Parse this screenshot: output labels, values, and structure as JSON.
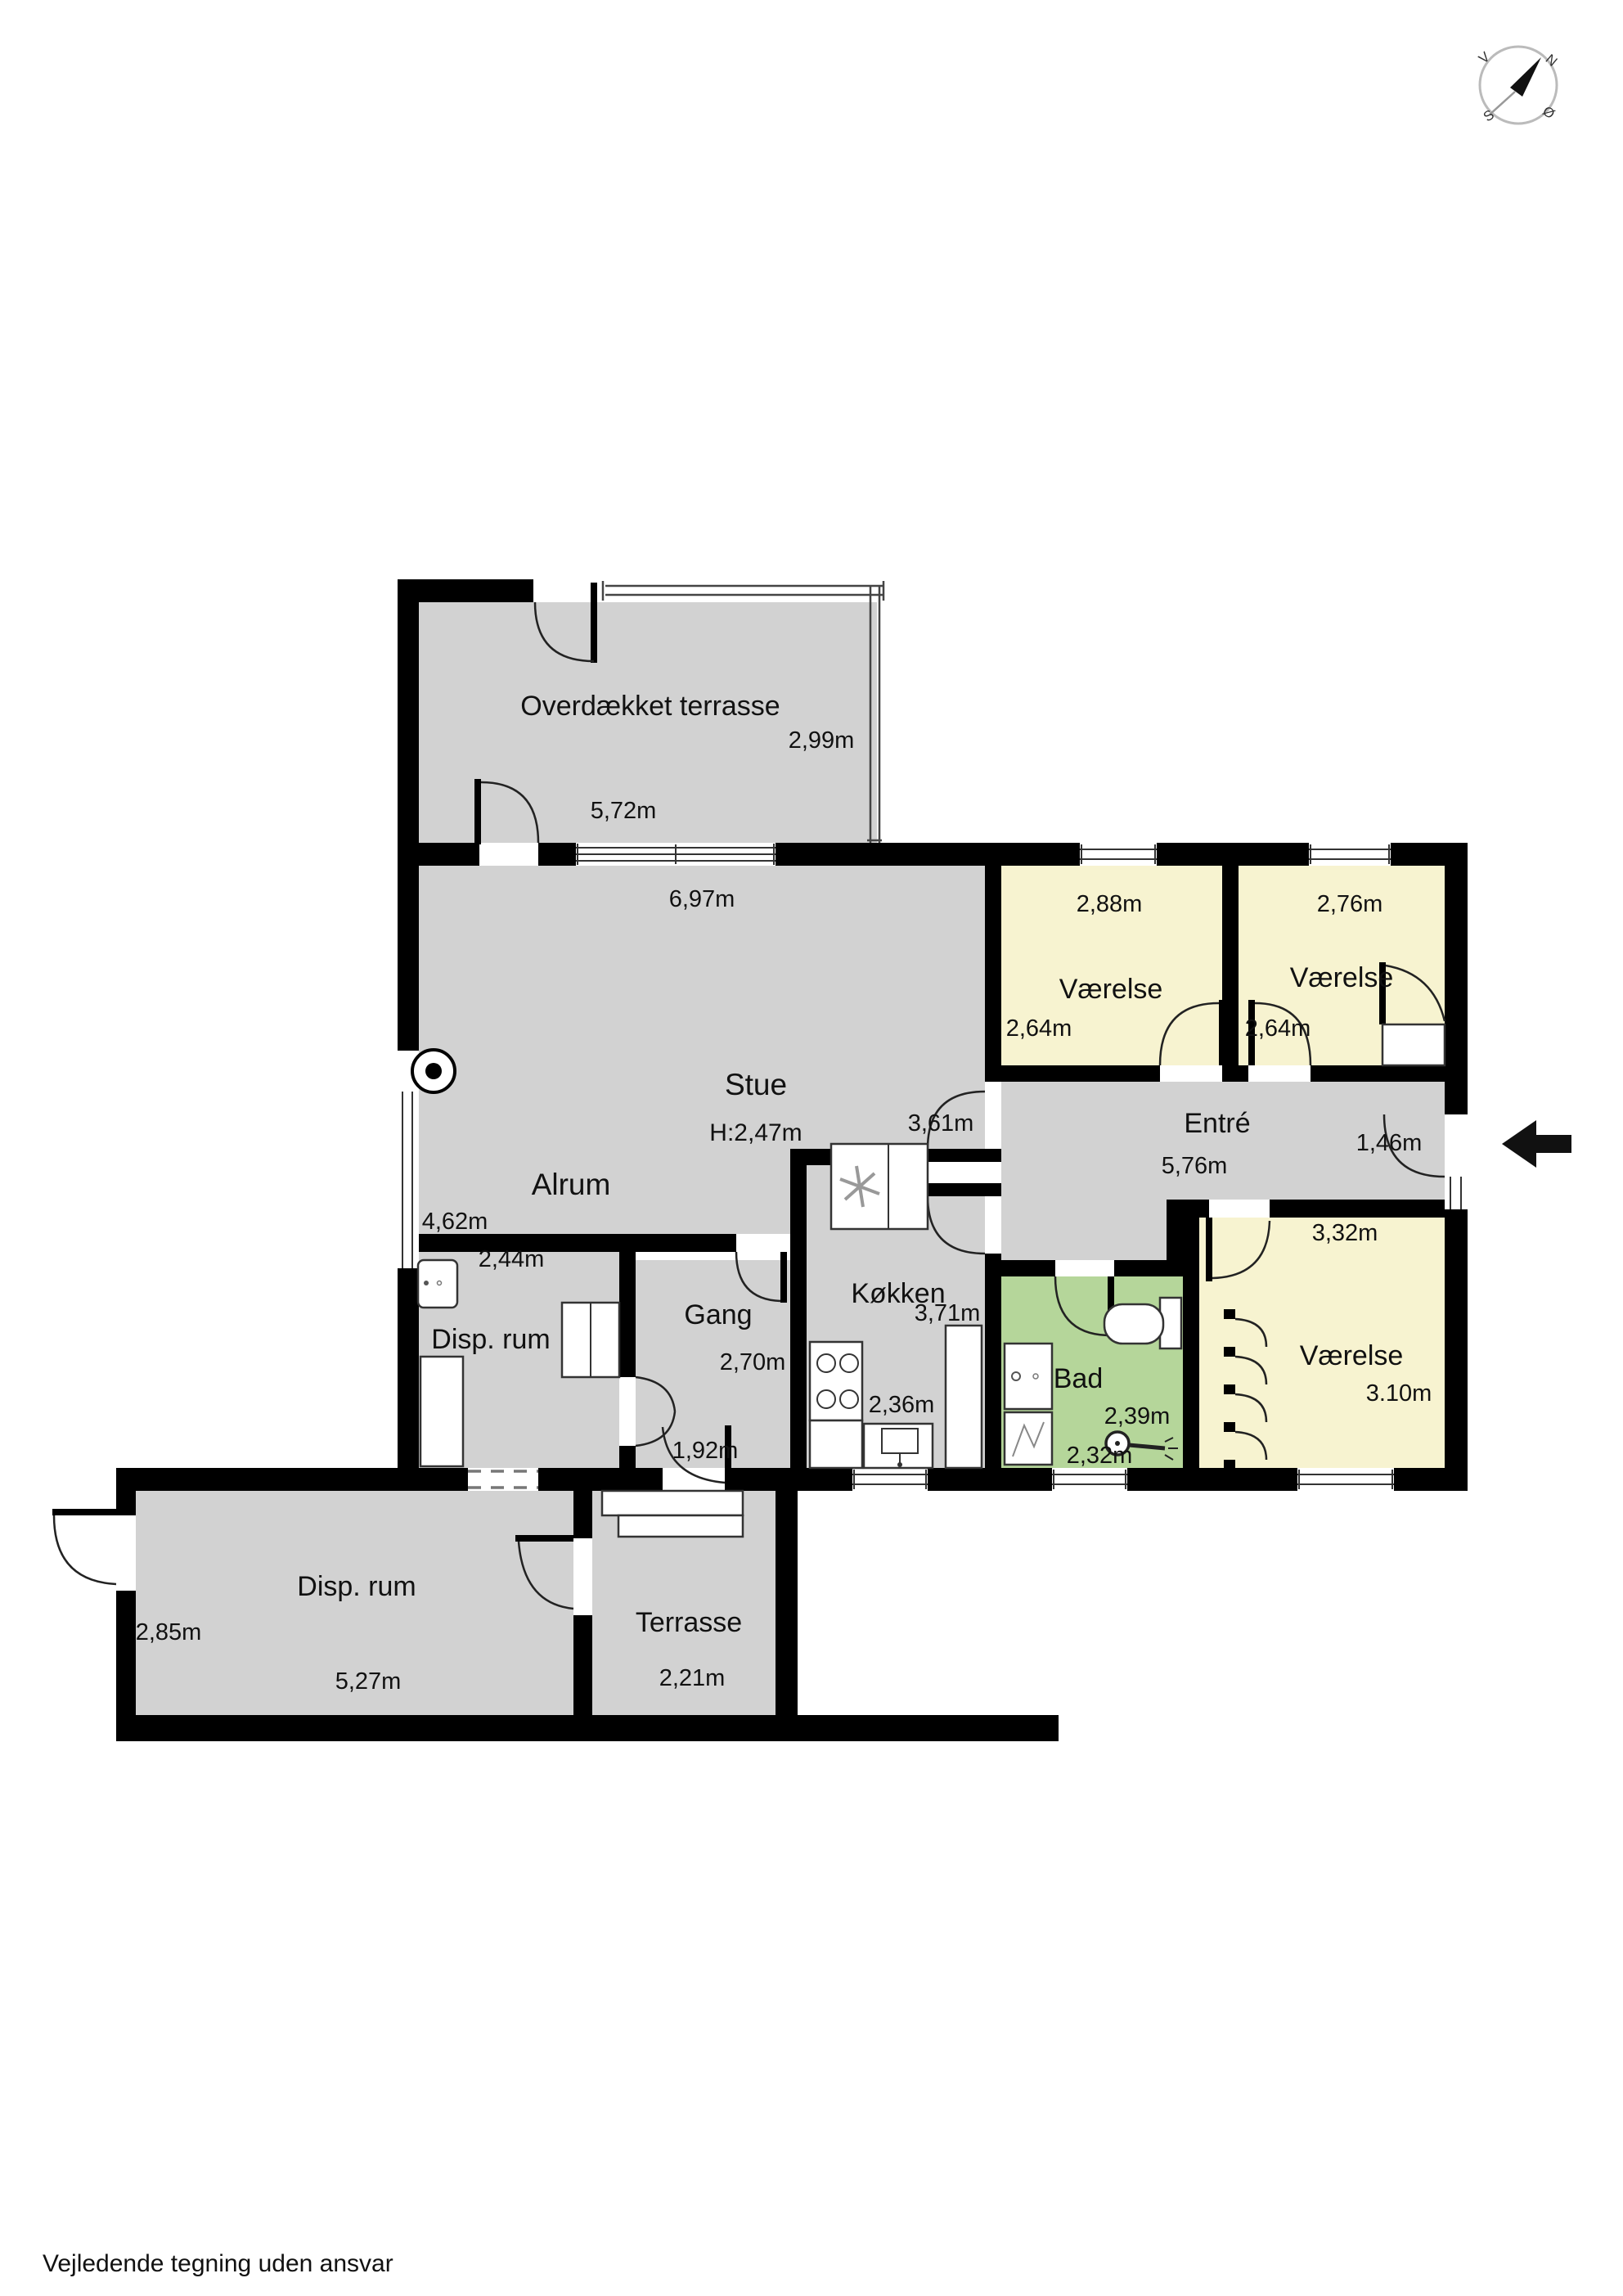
{
  "footer": "Vejledende tegning uden ansvar",
  "compass": {
    "north": "N",
    "west": "V",
    "south": "S",
    "east": "Ø"
  },
  "colors": {
    "floor": "#d2d2d2",
    "bedroom": "#f7f3d0",
    "bath": "#b5d69a",
    "wall": "#000000"
  },
  "rooms": {
    "covered_terrace": {
      "name": "Overdækket terrasse",
      "width": "5,72m",
      "depth": "2,99m"
    },
    "stue": {
      "name": "Stue",
      "ceiling_height": "H:2,47m",
      "width": "6,97m",
      "depth": "3,61m"
    },
    "alrum": {
      "name": "Alrum",
      "depth": "4,62m"
    },
    "bedroom_1": {
      "name": "Værelse",
      "width": "2,88m",
      "depth": "2,64m"
    },
    "bedroom_2": {
      "name": "Værelse",
      "width": "2,76m",
      "depth": "2,64m"
    },
    "entre": {
      "name": "Entré",
      "width": "5,76m",
      "depth": "1,46m"
    },
    "bedroom_3": {
      "name": "Værelse",
      "width": "3,32m",
      "depth": "3.10m"
    },
    "bad": {
      "name": "Bad",
      "width": "2,32m",
      "depth": "2,39m"
    },
    "koekken": {
      "name": "Køkken",
      "width": "2,36m",
      "depth": "3,71m"
    },
    "gang": {
      "name": "Gang",
      "width": "2,70m",
      "passage_width": "1,92m"
    },
    "disp_rum_upper": {
      "name": "Disp. rum",
      "width": "2,44m"
    },
    "disp_rum_lower": {
      "name": "Disp. rum",
      "width": "5,27m",
      "depth": "2,85m"
    },
    "terrasse": {
      "name": "Terrasse",
      "width": "2,21m"
    }
  }
}
